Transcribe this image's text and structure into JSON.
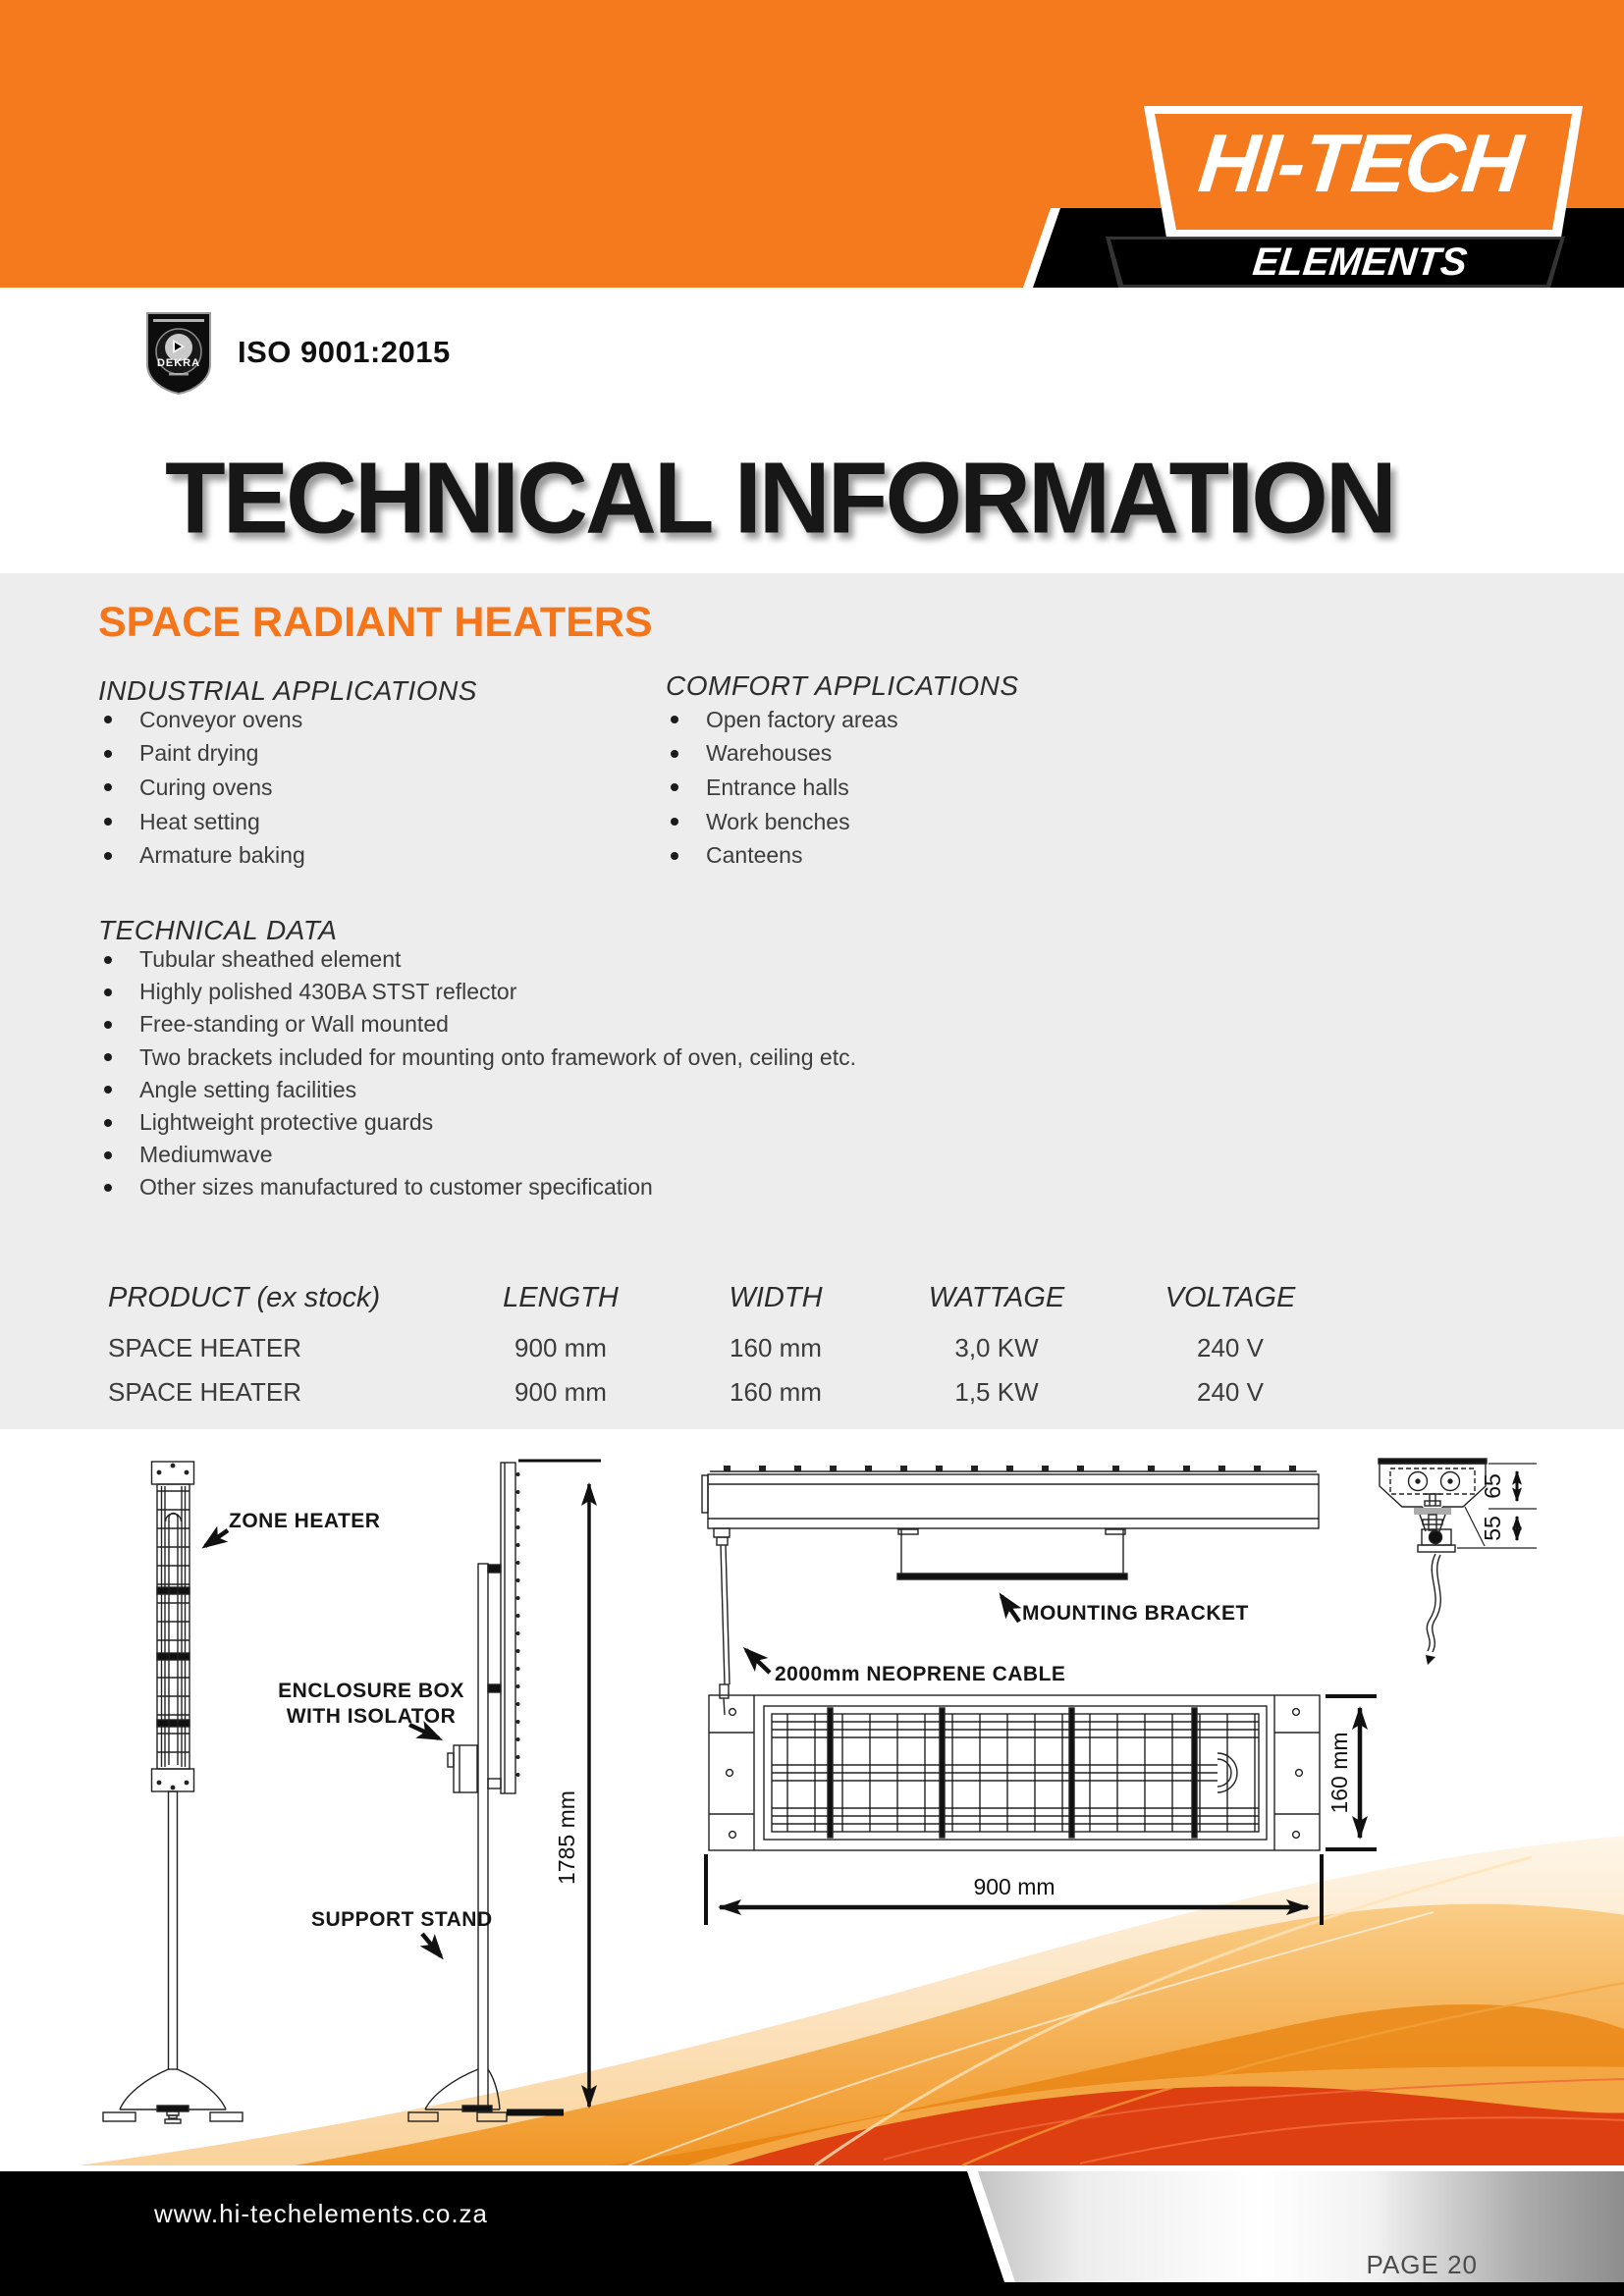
{
  "colors": {
    "orange": "#F5791D",
    "accent_heading": "#F4751A",
    "gray_band": "#EDEDED",
    "swoosh_red": "#DC3A10",
    "footer": "#000000"
  },
  "header": {
    "brand_top": "HI-TECH",
    "brand_bottom": "ELEMENTS",
    "iso_text": "ISO 9001:2015",
    "badge_label": "DEKRA"
  },
  "title": {
    "text": "TECHNICAL INFORMATION"
  },
  "intro": {
    "section_heading": "SPACE RADIANT HEATERS"
  },
  "industrial": {
    "heading": "INDUSTRIAL APPLICATIONS",
    "items": [
      "Conveyor ovens",
      "Paint drying",
      "Curing ovens",
      "Heat setting",
      "Armature baking"
    ]
  },
  "comfort": {
    "heading": "COMFORT APPLICATIONS",
    "items": [
      "Open factory areas",
      "Warehouses",
      "Entrance halls",
      "Work benches",
      "Canteens"
    ]
  },
  "technical": {
    "heading": "TECHNICAL DATA",
    "items": [
      "Tubular sheathed element",
      "Highly polished 430BA STST reflector",
      "Free-standing or Wall mounted",
      "Two brackets included for mounting onto framework of oven, ceiling etc.",
      "Angle setting facilities",
      "Lightweight protective guards",
      "Mediumwave",
      "Other sizes manufactured to customer specification"
    ]
  },
  "table": {
    "headers": [
      "PRODUCT (ex stock)",
      "LENGTH",
      "WIDTH",
      "WATTAGE",
      "VOLTAGE"
    ],
    "rows": [
      [
        "SPACE HEATER",
        "900 mm",
        "160 mm",
        "3,0 KW",
        "240 V"
      ],
      [
        "SPACE HEATER",
        "900 mm",
        "160 mm",
        "1,5 KW",
        "240 V"
      ]
    ]
  },
  "drawings": {
    "labels": {
      "zone_heater": "ZONE HEATER",
      "enclosure_line1": "ENCLOSURE BOX",
      "enclosure_line2": "WITH ISOLATOR",
      "support_stand": "SUPPORT STAND",
      "mounting_bracket": "MOUNTING BRACKET",
      "cable": "2000mm NEOPRENE CABLE"
    },
    "dimensions": {
      "stand_height": "1785 mm",
      "heater_length": "900 mm",
      "heater_width": "160 mm",
      "profile_top": "65",
      "profile_bottom": "55"
    }
  },
  "footer": {
    "website": "www.hi-techelements.co.za",
    "page_label": "PAGE 20"
  }
}
